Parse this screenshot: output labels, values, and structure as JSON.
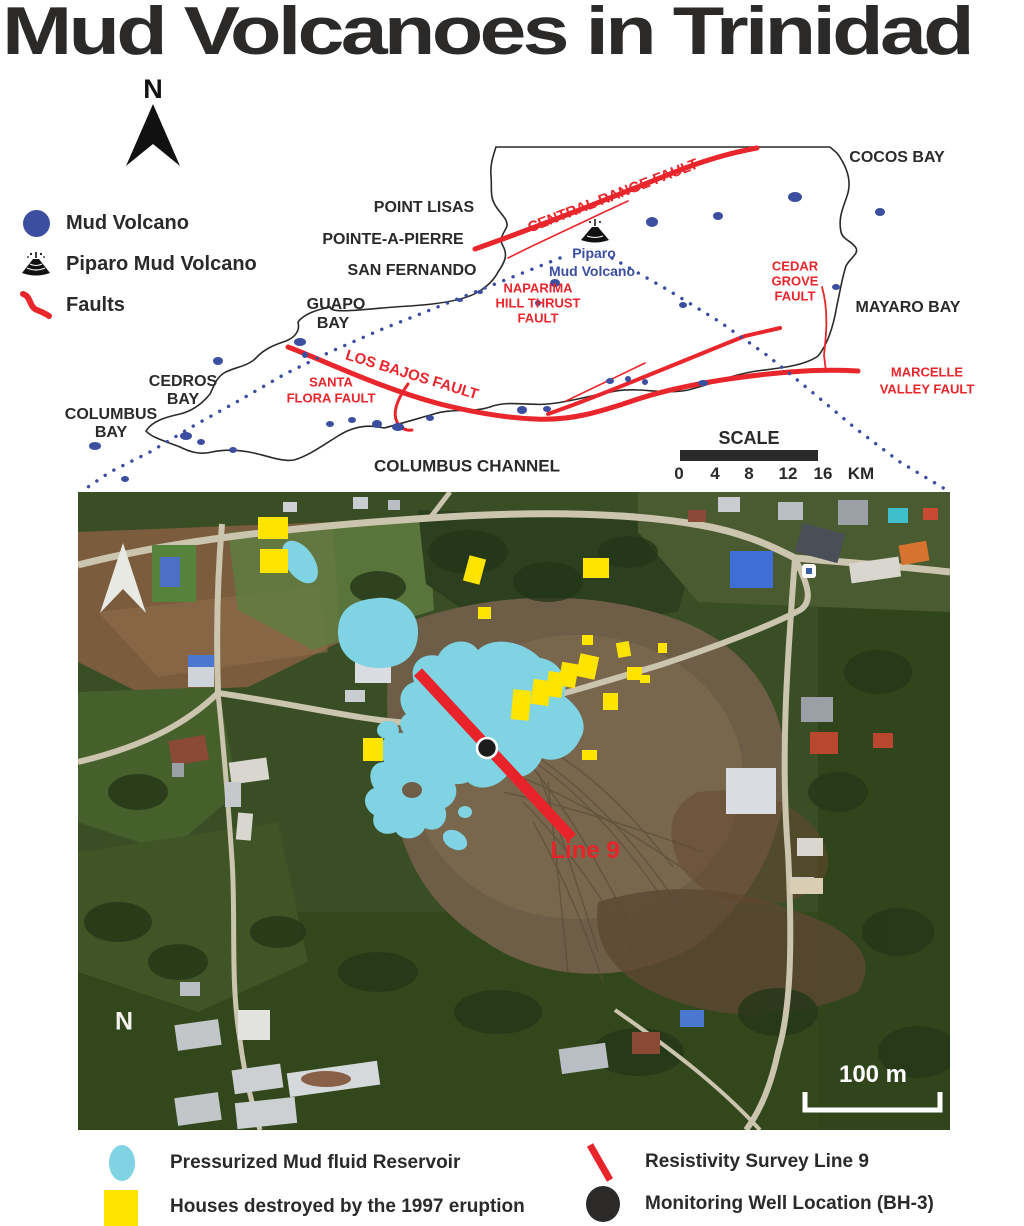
{
  "title": "Mud Volcanoes in Trinidad",
  "colors": {
    "fault_red": "#e8262b",
    "mud_volcano_blue": "#3b4ea0",
    "reservoir_cyan": "#7fd3e2",
    "house_yellow": "#ffe400",
    "text_black": "#2b2a29"
  },
  "compass": {
    "label": "N"
  },
  "legend_top": {
    "items": [
      {
        "icon": "mud-volcano-dot",
        "label": "Mud Volcano"
      },
      {
        "icon": "piparo-volcano",
        "label": "Piparo Mud Volcano"
      },
      {
        "icon": "fault-line",
        "label": "Faults"
      }
    ]
  },
  "map": {
    "labels": [
      {
        "text": "COCOS BAY",
        "x": 897,
        "y": 158
      },
      {
        "text": "POINT LISAS",
        "x": 424,
        "y": 208
      },
      {
        "text": "POINTE-A-PIERRE",
        "x": 393,
        "y": 240
      },
      {
        "text": "SAN FERNANDO",
        "x": 412,
        "y": 271
      },
      {
        "text": "GUAPO",
        "x": 336,
        "y": 305
      },
      {
        "text": "BAY",
        "x": 333,
        "y": 324
      },
      {
        "text": "CEDROS",
        "x": 183,
        "y": 382
      },
      {
        "text": "BAY",
        "x": 183,
        "y": 400
      },
      {
        "text": "COLUMBUS",
        "x": 111,
        "y": 415
      },
      {
        "text": "BAY",
        "x": 111,
        "y": 433
      },
      {
        "text": "MAYARO BAY",
        "x": 908,
        "y": 308
      },
      {
        "text": "COLUMBUS CHANNEL",
        "x": 467,
        "y": 466,
        "size": 17
      },
      {
        "text": "CENTRAL RANGE FAULT",
        "x": 613,
        "y": 196,
        "cls": "red",
        "rot": -21,
        "size": 15
      },
      {
        "text": "NAPARIMA",
        "x": 538,
        "y": 288,
        "cls": "red",
        "size": 13
      },
      {
        "text": "HILL THRUST",
        "x": 538,
        "y": 303,
        "cls": "red",
        "size": 13
      },
      {
        "text": "FAULT",
        "x": 538,
        "y": 318,
        "cls": "red",
        "size": 13
      },
      {
        "text": "CEDAR",
        "x": 795,
        "y": 266,
        "cls": "red",
        "size": 13
      },
      {
        "text": "GROVE",
        "x": 795,
        "y": 281,
        "cls": "red",
        "size": 13
      },
      {
        "text": "FAULT",
        "x": 795,
        "y": 296,
        "cls": "red",
        "size": 13
      },
      {
        "text": "LOS BAJOS FAULT",
        "x": 412,
        "y": 375,
        "cls": "red",
        "rot": 17,
        "size": 15
      },
      {
        "text": "SANTA",
        "x": 331,
        "y": 382,
        "cls": "red",
        "size": 13
      },
      {
        "text": "FLORA FAULT",
        "x": 331,
        "y": 398,
        "cls": "red",
        "size": 13
      },
      {
        "text": "MARCELLE",
        "x": 927,
        "y": 372,
        "cls": "red",
        "size": 13
      },
      {
        "text": "VALLEY FAULT",
        "x": 927,
        "y": 389,
        "cls": "red",
        "size": 13
      },
      {
        "text": "Piparo",
        "x": 594,
        "y": 253,
        "cls": "blue",
        "size": 14
      },
      {
        "text": "Mud Volcano",
        "x": 592,
        "y": 271,
        "cls": "blue",
        "size": 14
      }
    ],
    "mud_volcano_dots": [
      [
        652,
        222,
        6,
        5
      ],
      [
        718,
        216,
        5,
        4
      ],
      [
        795,
        197,
        7,
        5
      ],
      [
        880,
        212,
        5,
        4
      ],
      [
        836,
        287,
        4,
        3
      ],
      [
        555,
        283,
        5,
        4
      ],
      [
        683,
        305,
        4,
        3
      ],
      [
        538,
        303,
        3,
        3
      ],
      [
        300,
        342,
        6,
        4
      ],
      [
        218,
        361,
        5,
        4
      ],
      [
        186,
        436,
        6,
        4
      ],
      [
        201,
        442,
        4,
        3
      ],
      [
        233,
        450,
        4,
        3
      ],
      [
        330,
        424,
        4,
        3
      ],
      [
        352,
        420,
        4,
        3
      ],
      [
        377,
        424,
        5,
        4
      ],
      [
        398,
        427,
        6,
        4
      ],
      [
        522,
        410,
        5,
        4
      ],
      [
        547,
        409,
        4,
        3
      ],
      [
        610,
        381,
        4,
        3
      ],
      [
        628,
        379,
        3,
        3
      ],
      [
        645,
        382,
        3,
        3
      ],
      [
        703,
        383,
        5,
        3
      ],
      [
        95,
        446,
        6,
        4
      ],
      [
        125,
        479,
        4,
        3
      ],
      [
        305,
        355,
        3,
        3
      ],
      [
        430,
        418,
        4,
        3
      ],
      [
        460,
        300,
        3,
        2
      ],
      [
        480,
        292,
        3,
        2
      ]
    ],
    "dotted_lines": [
      {
        "points": [
          [
            560,
            258
          ],
          [
            500,
            282
          ],
          [
            440,
            306
          ],
          [
            380,
            330
          ],
          [
            330,
            352
          ],
          [
            285,
            374
          ],
          [
            240,
            400
          ],
          [
            195,
            425
          ],
          [
            150,
            452
          ],
          [
            110,
            472
          ],
          [
            85,
            489
          ]
        ]
      },
      {
        "points": [
          [
            612,
            258
          ],
          [
            668,
            290
          ],
          [
            720,
            322
          ],
          [
            768,
            356
          ],
          [
            812,
            392
          ],
          [
            855,
            428
          ],
          [
            900,
            462
          ],
          [
            945,
            489
          ]
        ]
      }
    ]
  },
  "scale_map": {
    "title": "SCALE",
    "ticks": [
      "0",
      "4",
      "8",
      "12",
      "16"
    ],
    "unit": "KM"
  },
  "satellite": {
    "line9_label": "Line 9",
    "scale_label": "100 m",
    "compass_label": "N",
    "line9": {
      "x1": 340,
      "y1": 180,
      "x2": 494,
      "y2": 346
    },
    "well": {
      "x": 409,
      "y": 256
    },
    "yellow_squares": [
      [
        180,
        25,
        30,
        22,
        0
      ],
      [
        182,
        57,
        28,
        24,
        0
      ],
      [
        388,
        65,
        17,
        26,
        15
      ],
      [
        505,
        66,
        26,
        20,
        0
      ],
      [
        400,
        115,
        13,
        12,
        0
      ],
      [
        285,
        246,
        20,
        23,
        0
      ],
      [
        434,
        198,
        18,
        30,
        5
      ],
      [
        454,
        188,
        18,
        25,
        8
      ],
      [
        469,
        180,
        16,
        25,
        8
      ],
      [
        482,
        171,
        17,
        24,
        10
      ],
      [
        500,
        163,
        19,
        23,
        12
      ],
      [
        504,
        143,
        11,
        10,
        0
      ],
      [
        539,
        150,
        13,
        15,
        -10
      ],
      [
        549,
        175,
        15,
        13,
        0
      ],
      [
        525,
        201,
        15,
        17,
        0
      ],
      [
        562,
        183,
        10,
        8,
        0
      ],
      [
        504,
        258,
        15,
        10,
        0
      ],
      [
        580,
        151,
        9,
        10,
        0
      ]
    ]
  },
  "legend_bottom": {
    "items": [
      {
        "icon": "reservoir",
        "label": "Pressurized Mud fluid Reservoir"
      },
      {
        "icon": "survey-line",
        "label": "Resistivity Survey Line 9"
      },
      {
        "icon": "destroyed-house",
        "label": "Houses destroyed by the 1997 eruption"
      },
      {
        "icon": "monitoring-well",
        "label": "Monitoring Well Location (BH-3)"
      }
    ]
  }
}
